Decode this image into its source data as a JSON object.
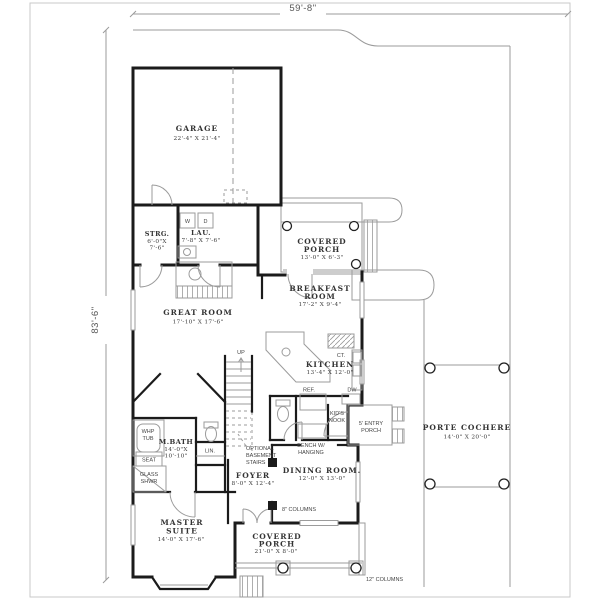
{
  "title": "House floor plan",
  "colors": {
    "wall": "#1b1b1b",
    "thin_line": "#9b9b9b",
    "text": "#3a3a3a",
    "frame": "#c9c9c9",
    "background": "#ffffff"
  },
  "dimensions": {
    "width": "59'-8\"",
    "height": "83'-6\""
  },
  "rooms": {
    "garage": {
      "name": "GARAGE",
      "dims": "22'-4\" X 21'-4\""
    },
    "storage": {
      "name": "STRG.",
      "dims_l1": "6'-0\"X",
      "dims_l2": "7'-6\""
    },
    "laundry": {
      "name": "LAU.",
      "dims": "7'-8\" X 7'-6\""
    },
    "covered_porch_upper": {
      "name_l1": "COVERED",
      "name_l2": "PORCH",
      "dims": "13'-0\" X 6'-3\""
    },
    "breakfast": {
      "name_l1": "BREAKFAST",
      "name_l2": "ROOM",
      "dims": "17'-2\" X 9'-4\""
    },
    "great_room": {
      "name": "GREAT ROOM",
      "dims": "17'-10\" X 17'-6\""
    },
    "kitchen": {
      "name": "KITCHEN",
      "dims": "13'-4\" X 12'-0\""
    },
    "master_bath": {
      "name": "M.BATH",
      "dims_l1": "14'-0\"X",
      "dims_l2": "10'-10\""
    },
    "foyer": {
      "name": "FOYER",
      "dims": "8'-0\" X 12'-4\""
    },
    "dining": {
      "name": "DINING ROOM.",
      "dims": "12'-0\" X 13'-0\""
    },
    "master_suite": {
      "name_l1": "MASTER",
      "name_l2": "SUITE",
      "dims": "14'-0\" X 17'-6\""
    },
    "covered_porch_lower": {
      "name_l1": "COVERED",
      "name_l2": "PORCH",
      "dims": "21'-0\" X 8'-0\""
    },
    "porte_cochere": {
      "name": "PORTE COCHERE",
      "dims": "14'-0\" X 20'-0\""
    },
    "entry_porch": {
      "name_l1": "5' ENTRY",
      "name_l2": "PORCH"
    },
    "kids_nook": {
      "name_l1": "KID'S",
      "name_l2": "NOOK"
    }
  },
  "annotations": {
    "up": "UP",
    "optional_stairs_l1": "OPTIONAL",
    "optional_stairs_l2": "BASEMENT",
    "optional_stairs_l3": "STAIRS",
    "bench_l1": "BENCH W/",
    "bench_l2": "HANGING",
    "whp_l1": "WHP",
    "whp_l2": "TUB",
    "seat": "SEAT",
    "glass_l1": "GLASS",
    "glass_l2": "SHWR",
    "linen": "LIN.",
    "washer": "W",
    "dryer": "D",
    "cooktop": "CT.",
    "refrigerator": "REF.",
    "dishwasher": "DW",
    "columns_8": "8\" COLUMNS",
    "columns_12": "12\" COLUMNS"
  }
}
